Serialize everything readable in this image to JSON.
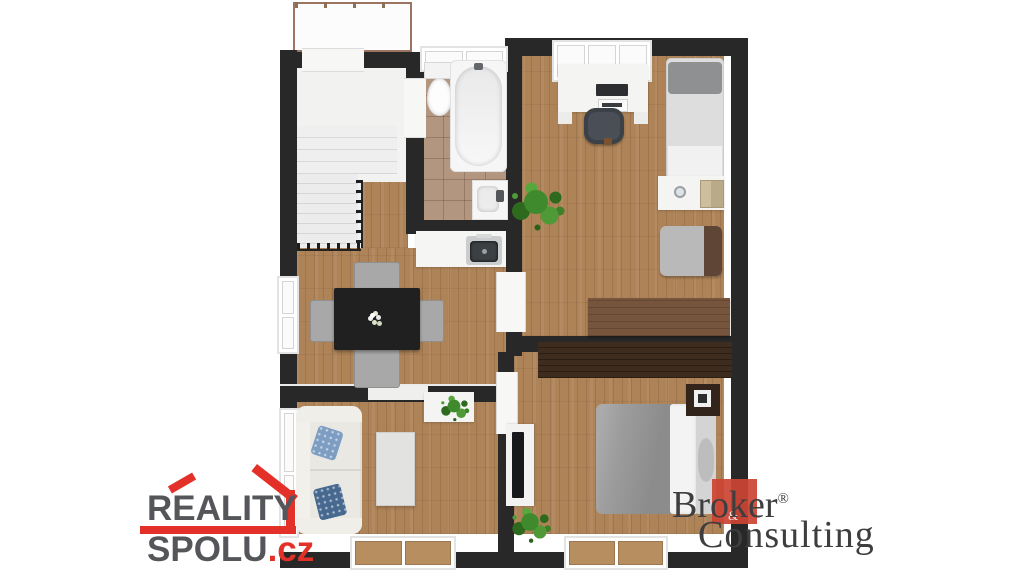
{
  "page": {
    "background": "#ffffff"
  },
  "floorplan": {
    "rooms": [
      {
        "id": "terrace"
      },
      {
        "id": "hallway-stairs"
      },
      {
        "id": "bathroom"
      },
      {
        "id": "kitchen-dining"
      },
      {
        "id": "study-bedroom"
      },
      {
        "id": "bedroom"
      },
      {
        "id": "living-room"
      }
    ],
    "palette": {
      "wall": "#282828",
      "wood_floor": "#ae8357",
      "tile_floor": "#b3967f",
      "fixture_white": "#f5f5f4",
      "blanket_gray": "#9c9c9c",
      "table_black": "#202020",
      "plant_green": "#3f8a2c",
      "dark_wood": "#3e2c1e"
    }
  },
  "watermarks": {
    "reality_spolu": {
      "word1": "REALITY",
      "word2": "SPOLU",
      "tld": ".cz",
      "text_color": "#54565a",
      "accent_color": "#e3312a"
    },
    "broker_consulting": {
      "word1": "Broker",
      "registered_mark": "®",
      "word2": "Consulting",
      "ampersand": "&",
      "text_color": "#3e3e40",
      "accent_color": "#cb4534"
    }
  }
}
